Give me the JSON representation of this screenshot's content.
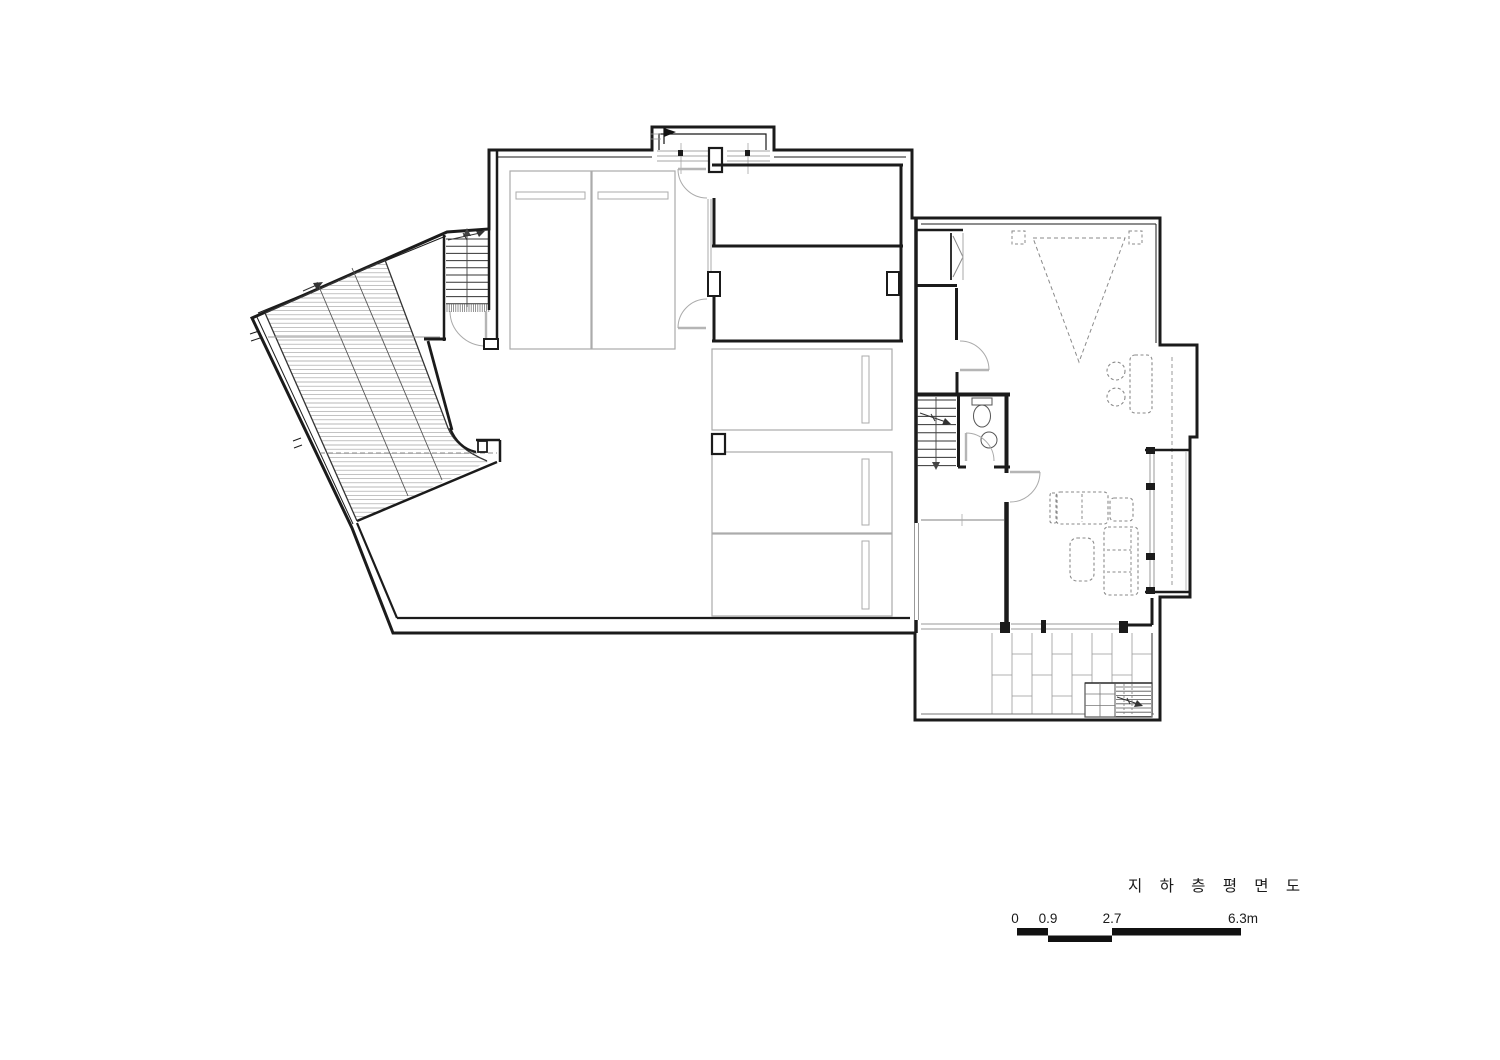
{
  "drawing": {
    "title": "지 하 층 평 면 도",
    "scale_bar": {
      "labels": [
        "0",
        "0.9",
        "2.7",
        "6.3m"
      ]
    }
  },
  "colors": {
    "wall": "#1b1b1b",
    "furniture_light": "#ababab",
    "furniture_dashed": "#8a8a8a",
    "hatch": "#9f9f9f",
    "paper": "#ffffff"
  }
}
